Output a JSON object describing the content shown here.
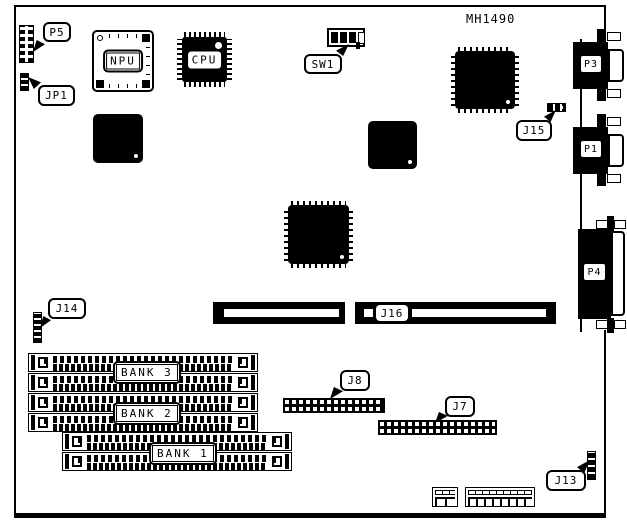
{
  "board": {
    "part_number": "MH1490"
  },
  "chips": {
    "npu": "NPU",
    "cpu": "CPU"
  },
  "io": {
    "p3": "P3",
    "p1": "P1",
    "p4": "P4"
  },
  "callouts": {
    "p5": "P5",
    "jp1": "JP1",
    "sw1": "SW1",
    "j15": "J15",
    "j14": "J14",
    "j16": "J16",
    "j8": "J8",
    "j7": "J7",
    "j13": "J13"
  },
  "memory": {
    "bank1": "BANK 1",
    "bank2": "BANK 2",
    "bank3": "BANK 3"
  },
  "colors": {
    "ink": "#000000",
    "paper": "#ffffff"
  }
}
